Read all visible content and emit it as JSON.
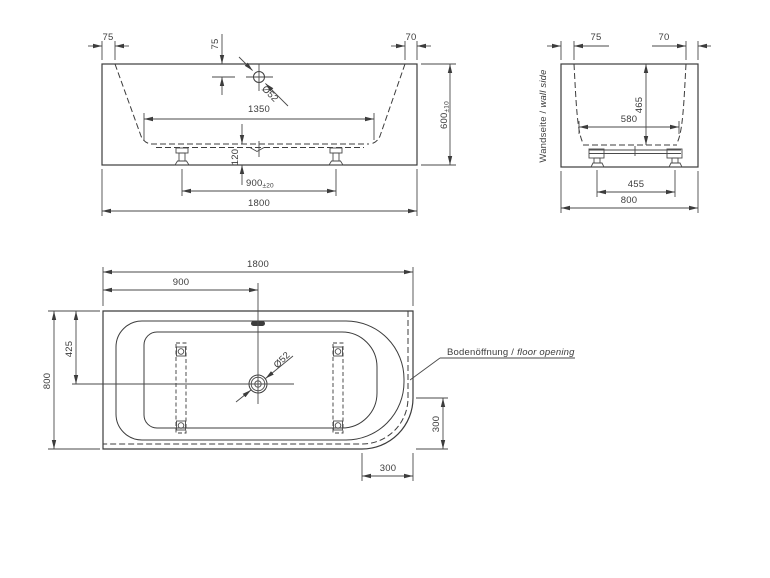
{
  "title": "Bathtub installation dimension drawing",
  "colors": {
    "line": "#3c3c3c",
    "background": "#ffffff"
  },
  "front_view": {
    "rim_left": "75",
    "overflow_offset": "75",
    "rim_right": "70",
    "overflow_diameter": "Ø52",
    "inner_length": "1350",
    "base_height": "120",
    "feet_spacing": "900",
    "feet_spacing_tol": "±20",
    "total_length": "1800",
    "total_height": "600",
    "total_height_tol": "±10"
  },
  "end_view": {
    "rim_left": "75",
    "rim_right": "70",
    "inner_depth": "465",
    "inner_width": "580",
    "feet_spacing": "455",
    "total_width": "800",
    "wall_label_de": "Wandseite /",
    "wall_label_en": "wall side"
  },
  "plan_view": {
    "total_length": "1800",
    "drain_from_left": "900",
    "drain_from_top": "425",
    "total_width": "800",
    "drain_diameter": "Ø52",
    "corner_radius_vertical": "300",
    "corner_radius_horizontal": "300",
    "floor_opening_label_de": "Bodenöffnung /",
    "floor_opening_label_en": "floor opening"
  }
}
